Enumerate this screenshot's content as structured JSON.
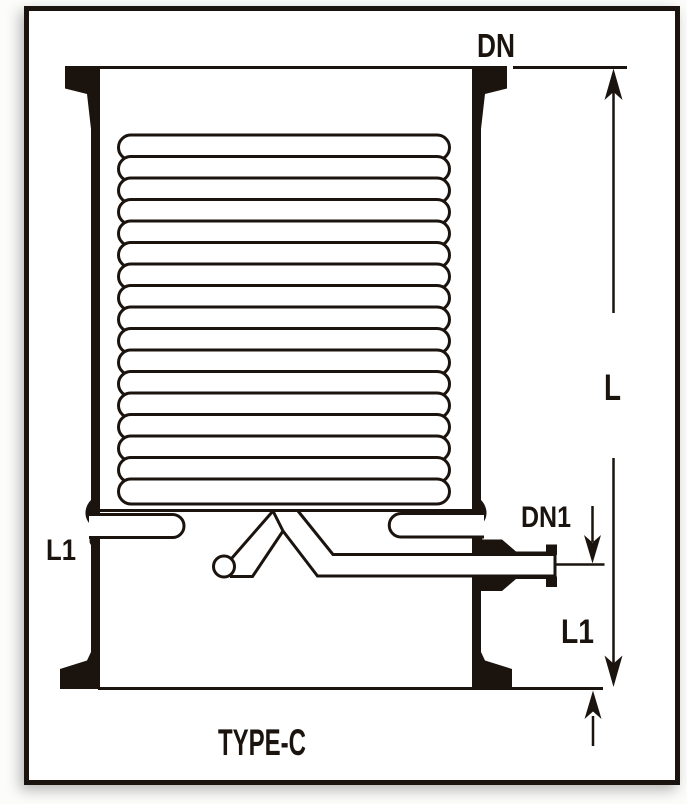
{
  "figure": {
    "type_label": "TYPE-C",
    "kind": "technical line drawing of a coil condenser vessel",
    "coil_turns": 17
  },
  "labels": {
    "dn": "DN",
    "dn1": "DN1",
    "l": "L",
    "l1_left": "L1",
    "l1_right": "L1",
    "type_c": "TYPE-C"
  },
  "colors": {
    "ink": "#1b130d",
    "paper": "#ffffff",
    "page_bg": "#fcfcfa"
  }
}
